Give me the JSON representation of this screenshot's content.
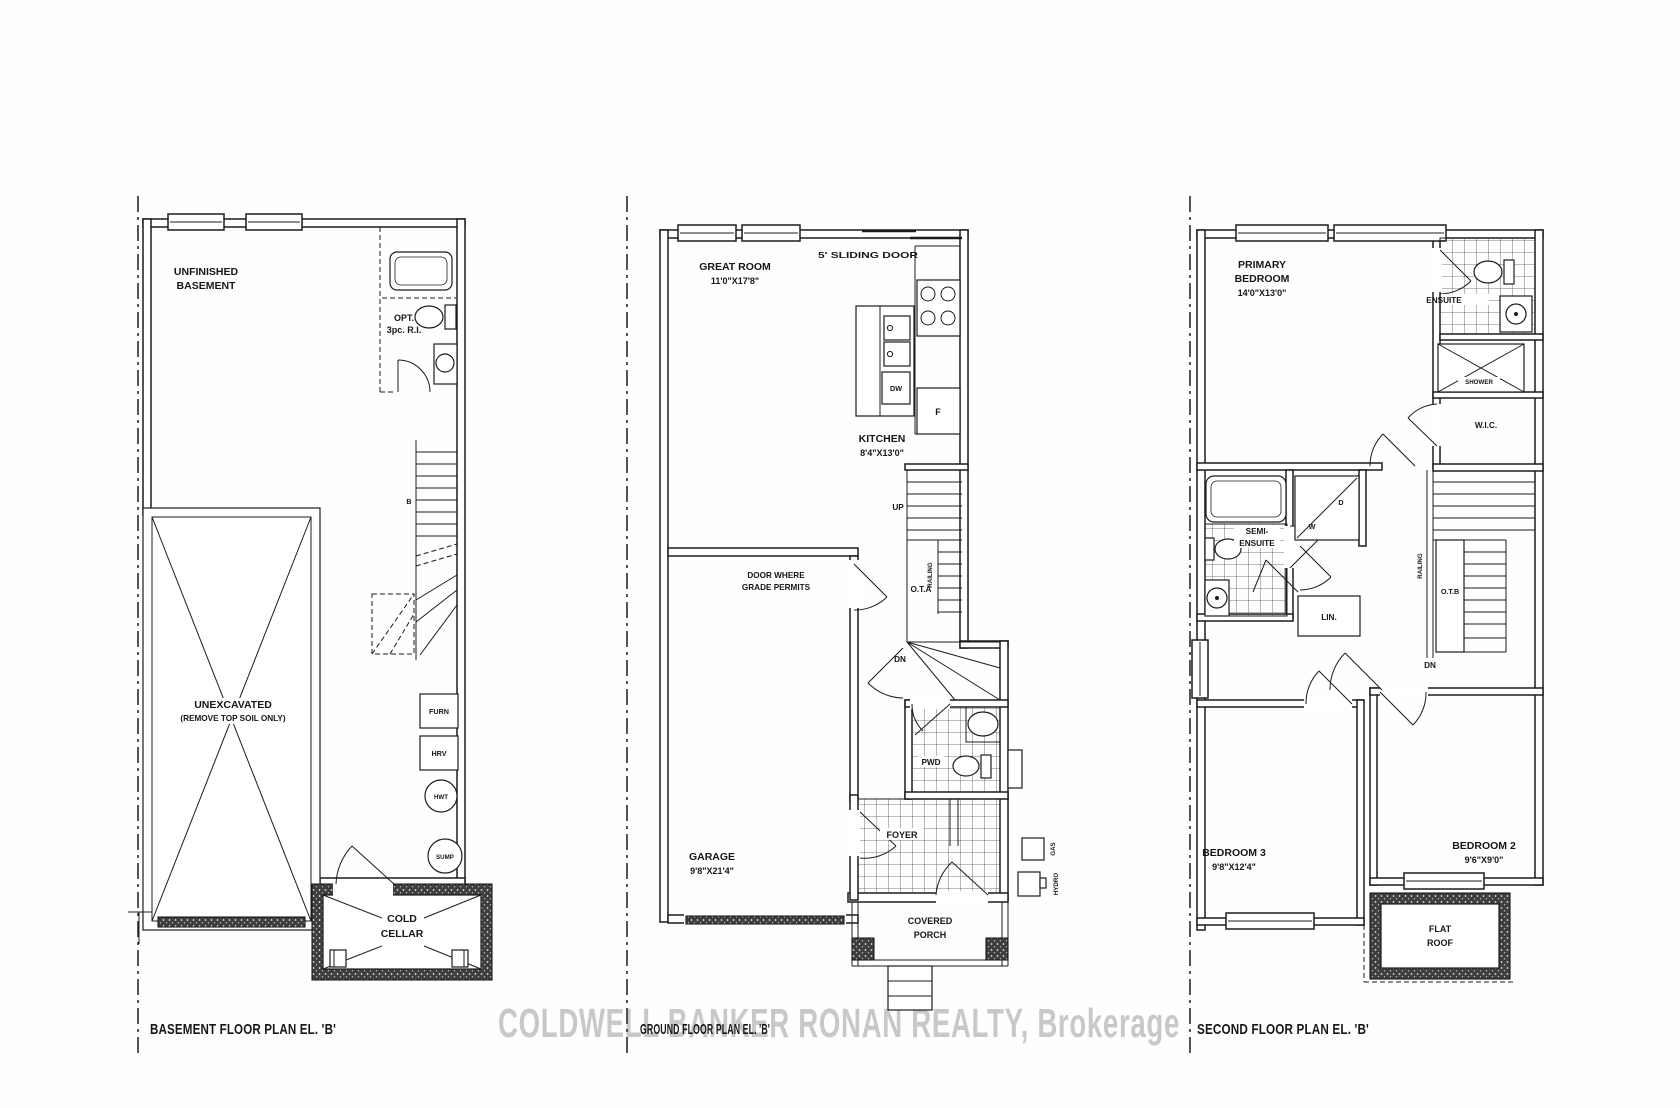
{
  "watermark": "COLDWELL BANKER RONAN REALTY, Brokerage",
  "plans": {
    "basement": {
      "title": "BASEMENT FLOOR PLAN EL. 'B'",
      "labels": {
        "unfinished_1": "UNFINISHED",
        "unfinished_2": "BASEMENT",
        "opt_1": "OPT.",
        "opt_2": "3pc. R.I.",
        "beam": "B",
        "unexcavated_1": "UNEXCAVATED",
        "unexcavated_2": "(REMOVE TOP SOIL ONLY)",
        "furn": "FURN",
        "hrv": "HRV",
        "hwt": "HWT",
        "sump": "SUMP",
        "cold_1": "COLD",
        "cold_2": "CELLAR"
      }
    },
    "ground": {
      "title": "GROUND FLOOR PLAN EL. 'B'",
      "labels": {
        "great_room_1": "GREAT ROOM",
        "great_room_2": "11'0\"X17'8\"",
        "sliding_door": "5' SLIDING DOOR",
        "kitchen_1": "KITCHEN",
        "kitchen_2": "8'4\"X13'0\"",
        "dw": "DW",
        "fridge": "F",
        "up": "UP",
        "railing": "RAILING",
        "ota": "O.T.A",
        "dn": "DN",
        "door_grade_1": "DOOR WHERE",
        "door_grade_2": "GRADE PERMITS",
        "garage_1": "GARAGE",
        "garage_2": "9'8\"X21'4\"",
        "pwd": "PWD",
        "foyer": "FOYER",
        "porch_1": "COVERED",
        "porch_2": "PORCH",
        "gas": "GAS",
        "hydro": "HYDRO"
      }
    },
    "second": {
      "title": "SECOND FLOOR PLAN EL. 'B'",
      "labels": {
        "primary_1": "PRIMARY",
        "primary_2": "BEDROOM",
        "primary_3": "14'0\"X13'0\"",
        "ensuite": "ENSUITE",
        "shower": "SHOWER",
        "wic": "W.I.C.",
        "semi_1": "SEMI-",
        "semi_2": "ENSUITE",
        "washer": "W",
        "dryer": "D",
        "lin": "LIN.",
        "railing": "RAILING",
        "otb": "O.T.B",
        "dn": "DN",
        "bedroom3_1": "BEDROOM 3",
        "bedroom3_2": "9'8\"X12'4\"",
        "bedroom2_1": "BEDROOM 2",
        "bedroom2_2": "9'6\"X9'0\"",
        "flat_roof_1": "FLAT",
        "flat_roof_2": "ROOF"
      }
    }
  }
}
